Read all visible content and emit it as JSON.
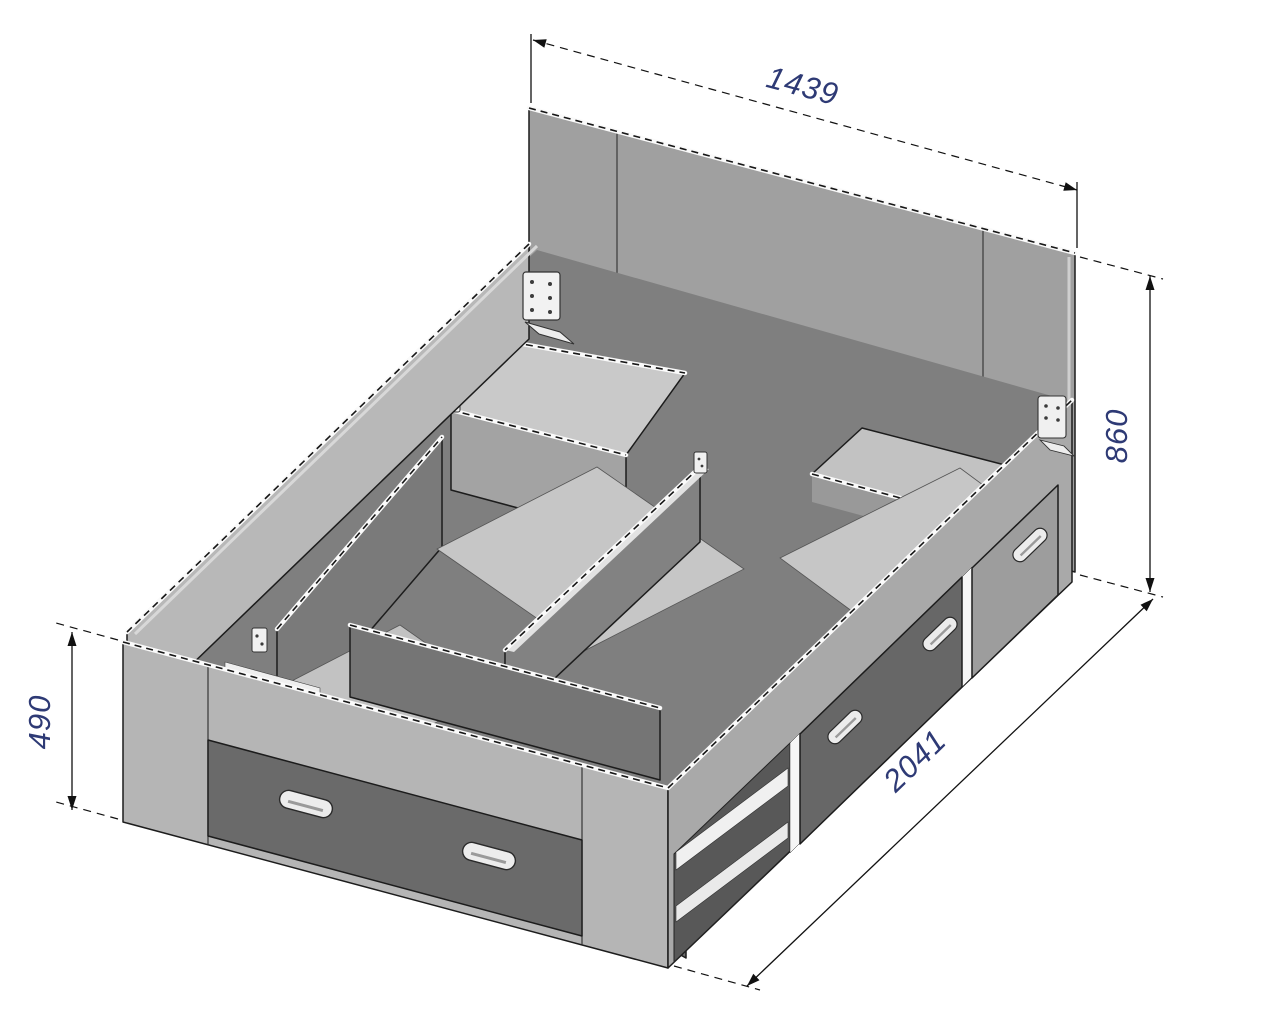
{
  "drawing": {
    "subject": "storage bed frame technical drawing",
    "view": "isometric line drawing",
    "background_color": "#ffffff"
  },
  "dimensions": {
    "top": {
      "label": "1439",
      "edge": "headboard width"
    },
    "right": {
      "label": "860",
      "edge": "headboard height"
    },
    "left": {
      "label": "490",
      "edge": "footboard height"
    },
    "bottom": {
      "label": "2041",
      "edge": "bed length"
    }
  },
  "style": {
    "dimension_text_color": "#2e3a75",
    "dimension_line_color": "#111111",
    "panel_light": "#b7b7b7",
    "panel_medium": "#a0a0a0",
    "interior_shadow": "#7f7f7f",
    "drawer_dark": "#6a6a6a",
    "floor_light": "#c6c6c6",
    "handle_fill": "#ececec"
  },
  "icons": [
    "drawer-handle-icon",
    "mounting-bracket-icon"
  ]
}
